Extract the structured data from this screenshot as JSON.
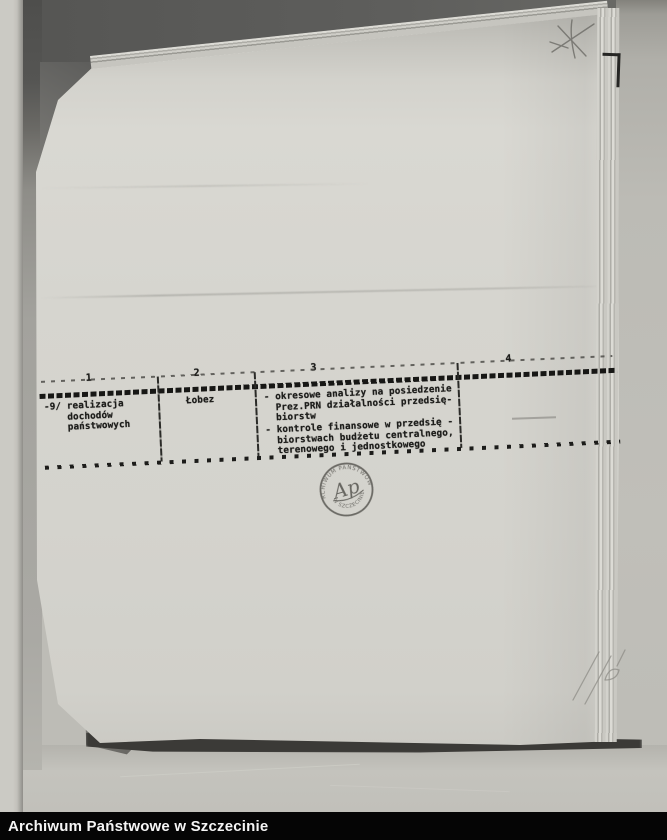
{
  "footer": {
    "label": "Archiwum Państwowe w Szczecinie"
  },
  "table": {
    "column_numbers": [
      "1",
      "2",
      "3",
      "4"
    ],
    "row": {
      "col1": "-9/ realizacja\n    dochodów\n    państwowych",
      "col2": "Łobez",
      "col3_item1": "- okresowe analizy na posiedzenie\n  Prez.PRN działalności przedsię-\n  biorstw",
      "col3_item2": "- kontrole finansowe w przedsię -\n  biorstwach budżetu centralnego,\n  terenowego i jednostkowego"
    }
  },
  "stamp": {
    "text_top": "ARCHIWUM PAŃSTWOWE",
    "text_bottom": "W SZCZECINIE",
    "monogram": "Ap"
  },
  "colors": {
    "footer_bg": "#050505",
    "footer_text": "#f5f5f5",
    "ink": "#1d1d1b",
    "page": "#d6d5cf"
  }
}
